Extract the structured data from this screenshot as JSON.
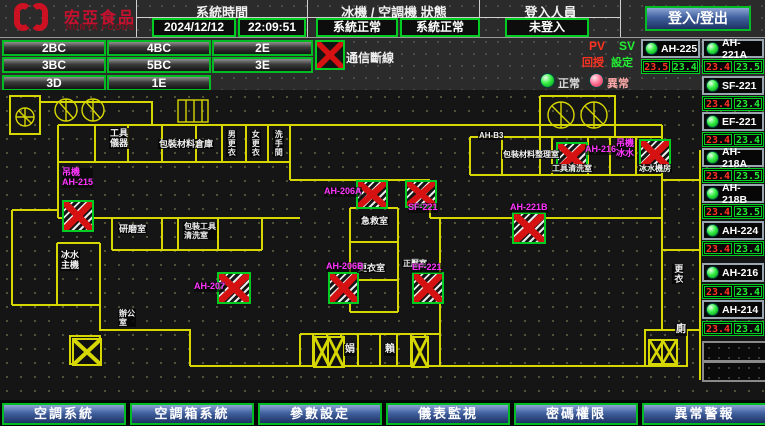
{
  "header": {
    "logo": {
      "brand": "宏亞食品",
      "brand_en": "HUNYA FOODS"
    },
    "system_time": {
      "label": "系統時間",
      "date": "2024/12/12",
      "time": "22:09:51"
    },
    "status": {
      "label": "冰機 / 空調機 狀態",
      "chiller": "系統正常",
      "ac": "系統正常"
    },
    "login": {
      "label": "登入人員",
      "value": "未登入",
      "button": "登入/登出"
    }
  },
  "floor_buttons": [
    "2BC",
    "4BC",
    "2E",
    "3BC",
    "5BC",
    "3E",
    "3D",
    "1E"
  ],
  "legend": {
    "comm_loss": "通信斷線",
    "normal": "正常",
    "abnormal": "異常",
    "pv": "PV",
    "sv": "SV",
    "pv_label": "回授",
    "sv_label": "設定"
  },
  "units": [
    {
      "name": "AH-225",
      "pv": "23.5",
      "sv": "23.4"
    },
    {
      "name": "AH-221A",
      "pv": "23.4",
      "sv": "23.5"
    },
    {
      "name": "SF-221",
      "pv": "23.4",
      "sv": "23.4"
    },
    {
      "name": "EF-221",
      "pv": "23.4",
      "sv": "23.4"
    },
    {
      "name": "AH-218A",
      "pv": "23.4",
      "sv": "23.5"
    },
    {
      "name": "AH-218B",
      "pv": "23.4",
      "sv": "23.5"
    },
    {
      "name": "AH-224",
      "pv": "23.4",
      "sv": "23.4"
    },
    {
      "name": "AH-216",
      "pv": "23.4",
      "sv": "23.4"
    },
    {
      "name": "AH-214",
      "pv": "23.4",
      "sv": "23.4"
    }
  ],
  "plan": {
    "room_labels": [
      {
        "text": "工具\n儀器"
      },
      {
        "text": "包裝材料倉庫"
      },
      {
        "text": "男更衣"
      },
      {
        "text": "女更衣"
      },
      {
        "text": "洗手間"
      },
      {
        "text": "AH-B3"
      },
      {
        "text": "包裝材料整理室"
      },
      {
        "text": "工具清洗室"
      },
      {
        "text": "冰水機房"
      },
      {
        "text": "急救室"
      },
      {
        "text": "更衣室"
      },
      {
        "text": "正壓室"
      },
      {
        "text": "研磨室"
      },
      {
        "text": "包裝工具\n清洗室"
      },
      {
        "text": "冰水\n主機"
      },
      {
        "text": "辦公\n室"
      },
      {
        "text": "娟"
      },
      {
        "text": "賴"
      },
      {
        "text": "更衣"
      },
      {
        "text": "廁"
      }
    ],
    "unit_labels": [
      {
        "text": "吊機\nAH-215"
      },
      {
        "text": "AH-206A"
      },
      {
        "text": "SF-221"
      },
      {
        "text": "AH-206B"
      },
      {
        "text": "EF-221"
      },
      {
        "text": "AH-216"
      },
      {
        "text": "吊機\n冰水"
      },
      {
        "text": "AH-221B"
      },
      {
        "text": "AH-207"
      }
    ]
  },
  "bottom_buttons": [
    "空調系統",
    "空調箱系統",
    "參數設定",
    "儀表監視",
    "密碼權限",
    "異常警報"
  ],
  "colors": {
    "accent_green": "#00cc22",
    "alarm_red": "#d51111",
    "magenta": "#ff35ff",
    "wall_yellow": "#d6d600",
    "button_blue": "#41619f",
    "pv_red": "#ff3322",
    "sv_green": "#22ee33"
  }
}
